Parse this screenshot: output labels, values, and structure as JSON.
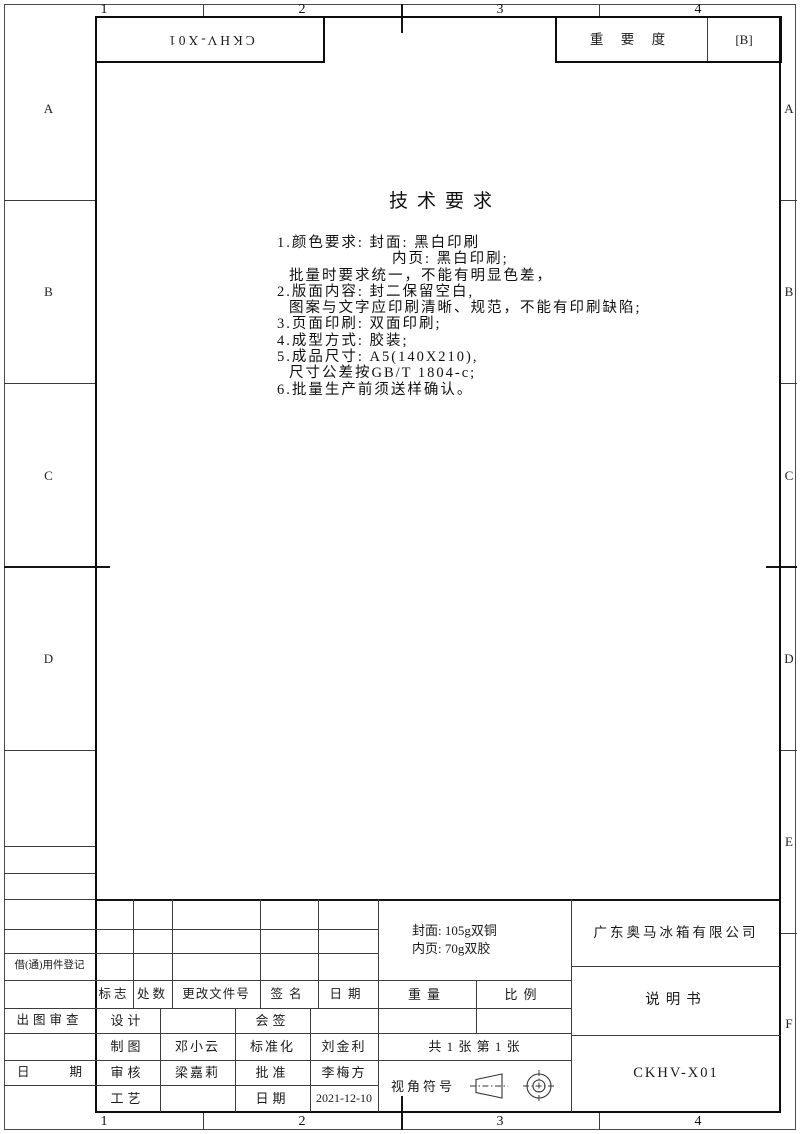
{
  "zones": {
    "top_columns": [
      "1",
      "2",
      "3",
      "4"
    ],
    "bottom_columns": [
      "1",
      "2",
      "3",
      "4"
    ],
    "left_rows": [
      "A",
      "B",
      "C",
      "D"
    ],
    "right_rows": [
      "A",
      "B",
      "C",
      "D",
      "E",
      "F"
    ]
  },
  "top_bar": {
    "rotated_code": "CKHV-X01",
    "importance_label": "重 要 度",
    "importance_value": "[B]"
  },
  "tech_requirements": {
    "title": "技术要求",
    "lines": [
      "1.颜色要求: 封面: 黑白印刷",
      "内页: 黑白印刷;",
      "批量时要求统一，不能有明显色差，",
      "2.版面内容: 封二保留空白,",
      "图案与文字应印刷清晰、规范，不能有印刷缺陷;",
      "3.页面印刷: 双面印刷;",
      "4.成型方式: 胶装;",
      "5.成品尺寸: A5(140X210),",
      "尺寸公差按GB/T 1804-c;",
      "6.批量生产前须送样确认。"
    ]
  },
  "title_block": {
    "left_margin": {
      "borrow_label": "借(通)用件登记",
      "review_label": "出图审查",
      "date_label": "日期"
    },
    "revision_header": {
      "mark": "标志",
      "count": "处数",
      "file_no": "更改文件号",
      "signature": "签名",
      "date": "日期"
    },
    "rows": [
      {
        "c1": "设计",
        "c2": "",
        "c3": "会签",
        "c4": ""
      },
      {
        "c1": "制图",
        "c2": "邓小云",
        "c3": "标准化",
        "c4": "刘金利"
      },
      {
        "c1": "审核",
        "c2": "梁嘉莉",
        "c3": "批准",
        "c4": "李梅方"
      },
      {
        "c1": "工艺",
        "c2": "",
        "c3": "日期",
        "c4": "2021-12-10"
      }
    ],
    "material": {
      "line1": "封面: 105g双铜",
      "line2": "内页: 70g双胶"
    },
    "weight_label": "重量",
    "scale_label": "比例",
    "sheet_count": "共 1 张 第 1 张",
    "view_symbol_label": "视角符号",
    "company": "广东奥马冰箱有限公司",
    "doc_title": "说明书",
    "doc_code": "CKHV-X01"
  }
}
